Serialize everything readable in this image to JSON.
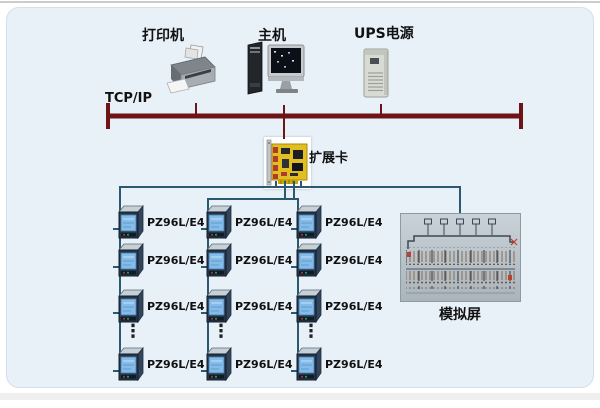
{
  "bus_label": "TCP/IP",
  "top_nodes": [
    {
      "id": "printer",
      "label": "打印机"
    },
    {
      "id": "host",
      "label": "主机"
    },
    {
      "id": "ups",
      "label": "UPS电源"
    }
  ],
  "expansion_card_label": "扩展卡",
  "mimic_panel_label": "模拟屏",
  "ellipsis": "⋮",
  "columns": [
    {
      "meters": [
        "PZ96L/E4",
        "PZ96L/E4",
        "PZ96L/E4",
        "PZ96L/E4"
      ]
    },
    {
      "meters": [
        "PZ96L/E4",
        "PZ96L/E4",
        "PZ96L/E4",
        "PZ96L/E4"
      ]
    },
    {
      "meters": [
        "PZ96L/E4",
        "PZ96L/E4",
        "PZ96L/E4",
        "PZ96L/E4"
      ]
    }
  ],
  "colors": {
    "background": "#e8f0f8",
    "bus_line": "#6f1416",
    "cable_line": "#2b5a70",
    "card_board": "#e2be1e",
    "meter_screen": "#85bbe8"
  }
}
